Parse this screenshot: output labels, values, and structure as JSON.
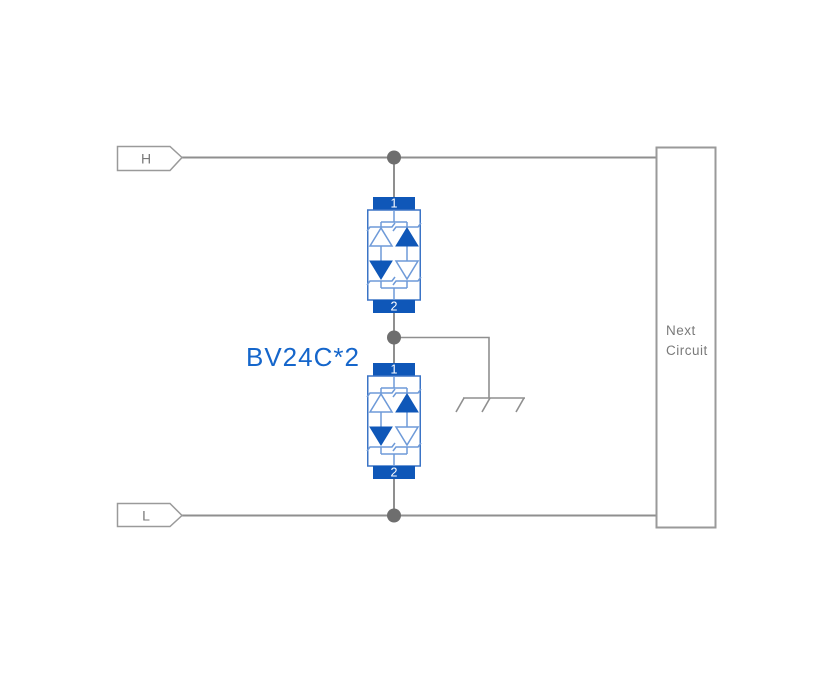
{
  "diagram": {
    "label": "BV24C*2",
    "tags": {
      "h": "H",
      "l": "L"
    },
    "next_circuit": {
      "line1": "Next",
      "line2": "Circuit"
    },
    "tvs_top": {
      "pin1": "1",
      "pin2": "2"
    },
    "tvs_bottom": {
      "pin1": "1",
      "pin2": "2"
    },
    "colors": {
      "component_blue": "#0F57B8",
      "component_border": "#3B74C6",
      "component_line": "#6E9AD8",
      "label_blue": "#1566CB",
      "wire": "#8F8F8F",
      "dot": "#6E6E6E",
      "gray_text": "#7A7A7A",
      "box_border": "#9A9A9A",
      "pin_text": "#FFFFFF"
    }
  }
}
